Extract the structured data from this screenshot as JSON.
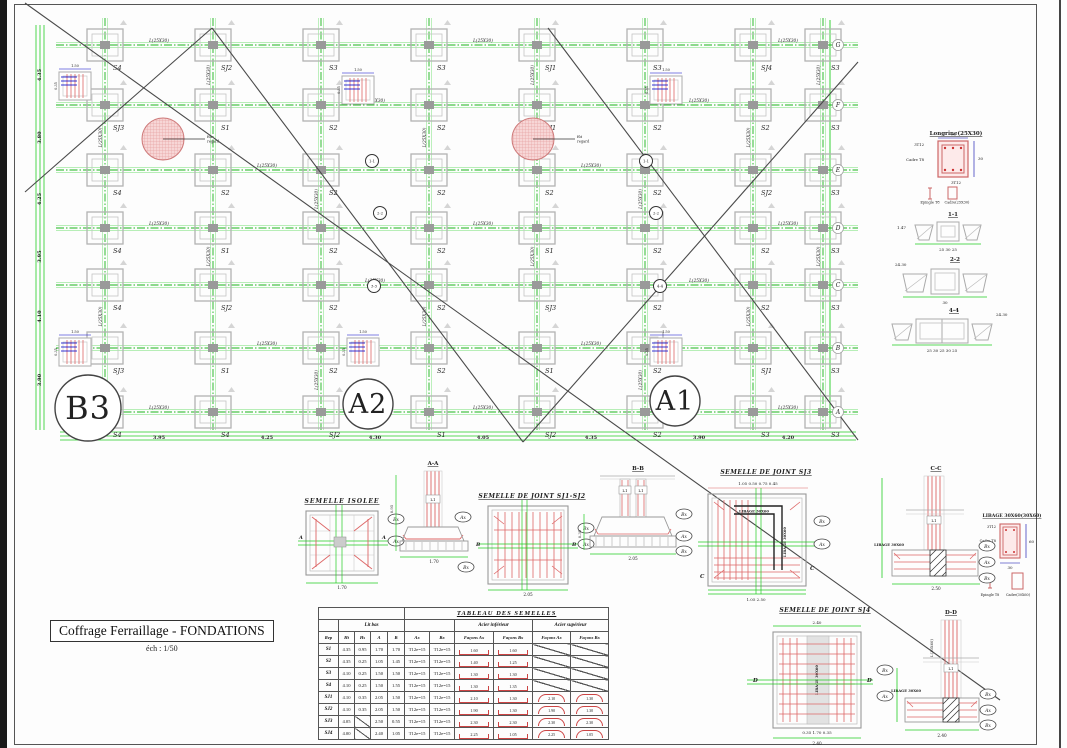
{
  "titleblock": {
    "title": "Coffrage Ferraillage - FONDATIONS",
    "scale": "éch : 1/50"
  },
  "plan": {
    "x_axes": [
      105,
      213,
      321,
      429,
      537,
      645,
      753,
      823
    ],
    "y_axes": [
      45,
      105,
      170,
      228,
      285,
      348,
      412
    ],
    "row_letters": [
      "G",
      "F",
      "E",
      "D",
      "C",
      "B",
      "A"
    ],
    "footing_labels": [
      [
        "S4",
        "SJ2",
        "S3",
        "S3",
        "SJ1",
        "S3",
        "SJ4",
        "S3"
      ],
      [
        "SJ3",
        "S1",
        "S2",
        "S2",
        "SJ1",
        "S2",
        "S2",
        "S3"
      ],
      [
        "S4",
        "S2",
        "S2",
        "S2",
        "S2",
        "S2",
        "SJ2",
        "S3"
      ],
      [
        "S4",
        "S1",
        "S2",
        "S2",
        "S1",
        "S2",
        "S2",
        "S3"
      ],
      [
        "S4",
        "SJ2",
        "S2",
        "S2",
        "SJ3",
        "S2",
        "S2",
        "S3"
      ],
      [
        "SJ3",
        "S1",
        "S2",
        "S2",
        "S1",
        "S2",
        "SJ1",
        "S3"
      ],
      [
        "S4",
        "S4",
        "SJ2",
        "S1",
        "SJ2",
        "S2",
        "S3",
        "S3"
      ]
    ],
    "longrine_label": "L(25X30)",
    "left_dims": [
      "4.35",
      "3.80",
      "4.25",
      "3.95",
      "4.10",
      "3.90"
    ],
    "bottom_dims": [
      "3.95",
      "4.25",
      "4.30",
      "4.05",
      "4.35",
      "3.90",
      "4.20"
    ],
    "detail_footings": [
      [
        75,
        86
      ],
      [
        358,
        90
      ],
      [
        666,
        90
      ],
      [
        75,
        352
      ],
      [
        363,
        352
      ],
      [
        666,
        352
      ]
    ],
    "red_circles": [
      {
        "x": 163,
        "y": 139
      },
      {
        "x": 533,
        "y": 139
      }
    ],
    "red_circle_note": [
      "fût",
      "regard"
    ],
    "section_markers": [
      {
        "x": 372,
        "y": 161,
        "t": "1-1"
      },
      {
        "x": 380,
        "y": 213,
        "t": "2-2"
      },
      {
        "x": 374,
        "y": 286,
        "t": "3-3"
      },
      {
        "x": 646,
        "y": 161,
        "t": "1-1"
      },
      {
        "x": 656,
        "y": 213,
        "t": "2-2"
      },
      {
        "x": 660,
        "y": 286,
        "t": "4-4"
      }
    ],
    "ref_circles": [
      {
        "label": "B3",
        "x": 88,
        "y": 408,
        "r": 33,
        "f": 32
      },
      {
        "label": "A2",
        "x": 368,
        "y": 404,
        "r": 25,
        "f": 27
      },
      {
        "label": "A1",
        "x": 675,
        "y": 401,
        "r": 25,
        "f": 27
      }
    ],
    "diagonals": [
      [
        25,
        3,
        1000,
        700
      ],
      [
        25,
        192,
        212,
        28
      ],
      [
        212,
        28,
        523,
        442
      ],
      [
        523,
        442,
        858,
        62
      ],
      [
        548,
        28,
        858,
        440
      ]
    ]
  },
  "details": {
    "longrine": {
      "title": "Longrine(25X30)",
      "top": "3T12",
      "bottom": "3T12",
      "left": "Cadre T8",
      "w": "25",
      "h": "30",
      "cap1": "Epingle T8",
      "cap2": "Cadre(25X30)"
    },
    "s11": {
      "title": "1-1",
      "dim_left": "1.47",
      "dim_bottom": "25 30 25"
    },
    "s22": {
      "title": "2-2",
      "dim_left": "24.30",
      "dim_bottom": "30"
    },
    "s44": {
      "title": "4-4",
      "dim_right": "24.30",
      "dim_bottom": "25 30 25 30 25"
    },
    "libage": {
      "title": "LIBAGE 30X60(30X60)",
      "top": "3T12",
      "left": "Cadre T8",
      "w": "30",
      "h": "60",
      "cap1": "Epingle T8",
      "cap2": "Cadre(30X60)"
    },
    "isolee": {
      "title": "SEMELLE ISOLEE",
      "section": "A-A",
      "ax": "Ax",
      "bx": "Bx",
      "l1": "L1",
      "dim_b": "1.70",
      "dim_b2": "1.70",
      "dim_h": "0.95",
      "mark": "A"
    },
    "sj12": {
      "title": "SEMELLE DE JOINT SJ1-SJ2",
      "section": "B-B",
      "l1": "L1",
      "l2": "L1",
      "ax": "Ax",
      "bx": "Bx",
      "bx2": "Bx",
      "dim_b": "2.05",
      "dim_b2": "2.05",
      "dim_h": "0.35",
      "mark": "B"
    },
    "sj3": {
      "title": "SEMELLE DE JOINT SJ3",
      "section": "C-C",
      "libage": "LIBAGE 30X60",
      "libage2": "LIBAGE 30X60",
      "l1": "L1",
      "ax": "Ax",
      "bx": "Bx",
      "bx2": "Bx",
      "top_dims": "1.05   0.50   0.75   0.45",
      "bot_dims": "1.05        2.50",
      "dim_b2": "2.50",
      "mark": "C"
    },
    "sj4": {
      "title": "SEMELLE DE JOINT SJ4",
      "section": "D-D",
      "libage": "LIBAGE 30X60",
      "libage2": "LIBAGE 30X60",
      "l1": "L1",
      "ax": "Ax",
      "bx": "Bx",
      "bx2": "Bx",
      "col": "L(30X60)",
      "top_dim": "2.40",
      "red_dims": "0.35  1.70  0.35",
      "dim_b": "2.40",
      "dim_b2": "2.40",
      "mark": "D"
    }
  },
  "table": {
    "title": "TABLEAU DES SEMELLES",
    "group1": "Lit bas",
    "group2": "Acier inférieur",
    "group3": "Acier supérieur",
    "cols": [
      "Rep",
      "Ht",
      "Hs",
      "A",
      "B",
      "Ax",
      "Bx",
      "Façons Ax",
      "Façons Bx",
      "Façons Ax",
      "Façons Bx"
    ],
    "rows": [
      {
        "rep": "S1",
        "ht": "4.35",
        "hs": "0.95",
        "a": "1.70",
        "b": "1.70",
        "ax": "T12e=15",
        "bx": "T12e=15",
        "fax": "1.60",
        "fbx": "1.60",
        "sax": null,
        "sbx": null
      },
      {
        "rep": "S2",
        "ht": "4.35",
        "hs": "0.25",
        "a": "1.05",
        "b": "1.45",
        "ax": "T12e=15",
        "bx": "T12e=15",
        "fax": "1.40",
        "fbx": "1.25",
        "sax": null,
        "sbx": null
      },
      {
        "rep": "S3",
        "ht": "4.10",
        "hs": "0.25",
        "a": "1.50",
        "b": "1.50",
        "ax": "T12e=15",
        "bx": "T12e=15",
        "fax": "1.30",
        "fbx": "1.30",
        "sax": null,
        "sbx": null
      },
      {
        "rep": "S4",
        "ht": "4.10",
        "hs": "0.25",
        "a": "1.50",
        "b": "1.55",
        "ax": "T12e=15",
        "bx": "T12e=15",
        "fax": "1.30",
        "fbx": "1.35",
        "sax": null,
        "sbx": null
      },
      {
        "rep": "SJ1",
        "ht": "4.10",
        "hs": "0.35",
        "a": "2.05",
        "b": "1.50",
        "ax": "T12e=15",
        "bx": "T12e=15",
        "fax": "2.10",
        "fbx": "1.30",
        "sax": "2.10",
        "sbx": "1.30"
      },
      {
        "rep": "SJ2",
        "ht": "4.10",
        "hs": "0.35",
        "a": "2.05",
        "b": "1.50",
        "ax": "T12e=15",
        "bx": "T12e=15",
        "fax": "1.90",
        "fbx": "1.30",
        "sax": "1.90",
        "sbx": "1.30"
      },
      {
        "rep": "SJ3",
        "ht": "4.05",
        "hs": null,
        "a": "2.50",
        "b": "0.55",
        "ax": "T12e=15",
        "bx": "T12e=15",
        "fax": "2.30",
        "fbx": "2.30",
        "sax": "2.30",
        "sbx": "2.30"
      },
      {
        "rep": "SJ4",
        "ht": "4.00",
        "hs": null,
        "a": "2.40",
        "b": "1.05",
        "ax": "T12e=15",
        "bx": "T12e=15",
        "fax": "2.25",
        "fbx": "1.05",
        "sax": "2.25",
        "sbx": "1.05"
      }
    ]
  }
}
